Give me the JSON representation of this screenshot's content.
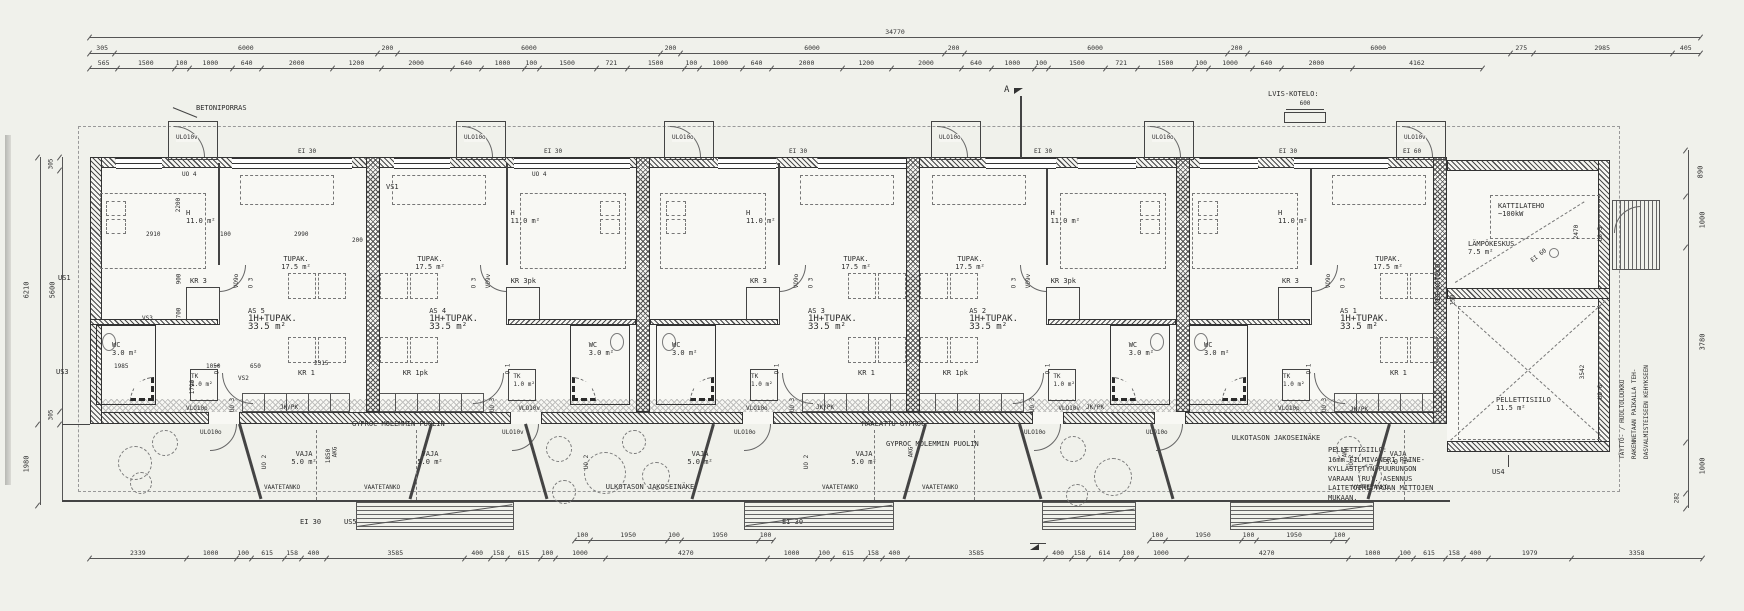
{
  "dim_rows": {
    "total": "34770",
    "modules": [
      "305",
      "6000",
      "200",
      "6000",
      "200",
      "6000",
      "200",
      "6000",
      "200",
      "6000",
      "275",
      "2985",
      "405"
    ],
    "detail": [
      "565",
      "1500",
      "100",
      "1000",
      "640",
      "2000",
      "1200",
      "2000",
      "640",
      "1000",
      "100",
      "1500",
      "721",
      "1500",
      "100",
      "1000",
      "640",
      "2000",
      "1200",
      "2000",
      "640",
      "1000",
      "100",
      "1500",
      "721",
      "1500",
      "100",
      "1000",
      "640",
      "2000",
      "4162"
    ],
    "bottom": [
      "2339",
      "1000",
      "100",
      "615",
      "158",
      "400",
      "3585",
      "400",
      "158",
      "615",
      "100",
      "1000",
      "4270",
      "1000",
      "100",
      "615",
      "158",
      "400",
      "3585",
      "400",
      "158",
      "614",
      "100",
      "1000",
      "4270",
      "1000",
      "100",
      "615",
      "158",
      "400",
      "1979",
      "3358"
    ],
    "terrace_sub": [
      "100",
      "1950",
      "100",
      "1950",
      "100"
    ],
    "left_inner": [
      "305",
      "5600",
      "305"
    ],
    "left_total": "6210",
    "left_lower": "1980",
    "right": [
      "890",
      "1000",
      "3780",
      "1000",
      "282"
    ]
  },
  "apartments": [
    {
      "id": "AS 5",
      "type": "1H+TUPAK.",
      "area": "33.5 m²",
      "h": "H",
      "h_area": "11.0 m²",
      "tupak": "TUPAK.",
      "tupak_area": "17.5 m²",
      "kr_top": "KR 3",
      "kr_bottom": "KR 1",
      "wc": "WC",
      "wc_area": "3.0 m²",
      "tk": "TK",
      "tk_area": "1.0 m²",
      "door_bed": "VO9o",
      "door_in": "VLO10p",
      "uo3": "UO 3",
      "o3": "O 3",
      "o1": "O 1"
    },
    {
      "id": "AS 4",
      "type": "1H+TUPAK.",
      "area": "33.5 m²",
      "h": "H",
      "h_area": "11.0 m²",
      "tupak": "TUPAK.",
      "tupak_area": "17.5 m²",
      "kr_top": "KR 3pk",
      "kr_bottom": "KR 1pk",
      "wc": "WC",
      "wc_area": "3.0 m²",
      "tk": "TK",
      "tk_area": "1.0 m²",
      "door_bed": "VO9v",
      "door_in": "VLO10v",
      "uo3": "UO 3",
      "o3": "O 3",
      "o1": "O 1"
    },
    {
      "id": "AS 3",
      "type": "1H+TUPAK.",
      "area": "33.5 m²",
      "h": "H",
      "h_area": "11.0 m²",
      "tupak": "TUPAK.",
      "tupak_area": "17.5 m²",
      "kr_top": "KR 3",
      "kr_bottom": "KR 1",
      "wc": "WC",
      "wc_area": "3.0 m²",
      "tk": "TK",
      "tk_area": "1.0 m²",
      "door_bed": "VO9o",
      "door_in": "VLO10o",
      "uo3": "UO 3",
      "o3": "O 3",
      "o1": "O 1"
    },
    {
      "id": "AS 2",
      "type": "1H+TUPAK.",
      "area": "33.5 m²",
      "h": "H",
      "h_area": "11.0 m²",
      "tupak": "TUPAK.",
      "tupak_area": "17.5 m²",
      "kr_top": "KR 3pk",
      "kr_bottom": "KR 1pk",
      "wc": "WC",
      "wc_area": "3.0 m²",
      "tk": "TK",
      "tk_area": "1.0 m²",
      "door_bed": "VO9v",
      "door_in": "VLO10v",
      "uo3": "UO 3",
      "o3": "O 3",
      "o1": "O 1"
    },
    {
      "id": "AS 1",
      "type": "1H+TUPAK.",
      "area": "33.5 m²",
      "h": "H",
      "h_area": "11.0 m²",
      "tupak": "TUPAK.",
      "tupak_area": "17.5 m²",
      "kr_top": "KR 3",
      "kr_bottom": "KR 1",
      "wc": "WC",
      "wc_area": "3.0 m²",
      "tk": "TK",
      "tk_area": "1.0 m²",
      "door_bed": "VO9o",
      "door_in": "VLO10p",
      "uo3": "UO 3",
      "o3": "O 3",
      "o1": "O 1"
    }
  ],
  "as5_dims": {
    "d2200": "2200",
    "d2910": "2910",
    "d100": "100",
    "d2990": "2990",
    "d900": "900",
    "d700": "700",
    "d1985": "1985",
    "d1050": "1050",
    "d650": "650",
    "d2315": "2315",
    "d1790": "1790",
    "d200": "200"
  },
  "top_area": {
    "betoniporras": "BETONIPORRAS",
    "kotelo": "LVIS-KOTELO:",
    "kotelo_dim": "600",
    "section": "A",
    "uo4": "UO 4",
    "vs1": "VS1",
    "ei30": "EI 30",
    "ei60": "EI 60",
    "doors": [
      "ULO10v",
      "ULO10o",
      "ULO10o",
      "ULO10o",
      "ULO10o",
      "ULO10v"
    ]
  },
  "bottom_area": {
    "vaja": "VAJA",
    "vaja_area": "5.0 m²",
    "rail": "VAATETANKO",
    "partition": "ULKOTASON JAKOSEINÄKE",
    "gyproc": "GYPROC MOLEMMIN PUOLIN",
    "gyproc_painted": "MAALATTU GYPROC",
    "ei30": "EI 30",
    "us5": "US5",
    "uo2": "UO 2",
    "d1850": "1850",
    "jkpk": "JK/PK",
    "akg": "AKG",
    "doors": [
      "ULO10o",
      "ULO10v",
      "ULO10o",
      "ULO10o",
      "ULO10o"
    ]
  },
  "walls": {
    "us1": "US1",
    "us3": "US3",
    "vs2": "VS2",
    "vs3": "VS3"
  },
  "annex": {
    "boiler": "LÄMPÖKESKUS",
    "boiler_area": "7.5 m²",
    "power1": "KATTILATEHO",
    "power2": "~100kW",
    "ei60": "EI 60",
    "d2470": "2470",
    "d3542": "3542",
    "d150": "150",
    "silo": "PELLETTISIILO",
    "silo_area": "11.5 m²",
    "uo5": "UO 5",
    "uo6": "UO 6",
    "us4": "US4",
    "kotelo_v": "LVIS-KOTELO"
  },
  "notes": {
    "silo": [
      "PELLETTISIILO:",
      "16mm FILMIVANERI PAINE-",
      "KYLLÄSTETYN PUURUNGON",
      "VARAAN (RU). ASENNUS",
      "LAITETOIMITTAJAN MITTOJEN",
      "MUKAAN."
    ],
    "hatch": [
      "TÄYTTÖ- / HUOLTOLUUKKU",
      "RAKENNETAAN PAIKALLA TEH-",
      "DASVALMISTEISEEN KEHYKSEEN"
    ]
  }
}
